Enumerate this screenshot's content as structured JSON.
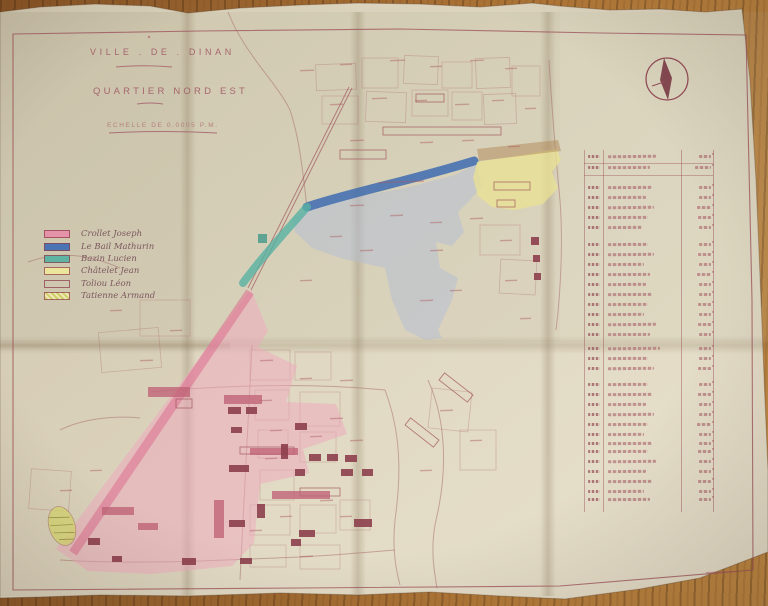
{
  "photo": {
    "subject": "hand-drawn cadastral expropriation plan on folded paper, photographed on a wooden table",
    "wood_color": "#a26b31",
    "paper_color": "#e0d8c2",
    "ink_color": "#9c4f58"
  },
  "title_block": {
    "city": "VILLE . DE . DINAN",
    "district": "QUARTIER NORD EST",
    "scale": "ECHELLE DE 0.0005 P.M."
  },
  "legend": {
    "items": [
      {
        "label": "Crollet Joseph",
        "color": "#e493a9",
        "style": "solid"
      },
      {
        "label": "Le Bail Mathurin",
        "color": "#4a74b4",
        "style": "solid"
      },
      {
        "label": "Bazin Lucien",
        "color": "#5fb3a3",
        "style": "solid"
      },
      {
        "label": "Châtelet Jean",
        "color": "#ece59c",
        "style": "solid"
      },
      {
        "label": "Toliou Léon",
        "color": "none",
        "style": "outline"
      },
      {
        "label": "Tatienne Armand",
        "color": "#d6d66e",
        "style": "hatched"
      }
    ]
  },
  "compass": {
    "icon": "compass-rose",
    "ink": "#7c3a46"
  },
  "register_table": {
    "legible": false,
    "note": "faint handwritten register: parcel number, owner name, surface (m2); text too small to read",
    "rows": [
      {
        "y": 155,
        "nw": 48,
        "vw": 12
      },
      {
        "y": 166,
        "nw": 42,
        "vw": 16
      },
      {
        "y": 186,
        "nw": 44,
        "vw": 12
      },
      {
        "y": 196,
        "nw": 38,
        "vw": 12
      },
      {
        "y": 206,
        "nw": 46,
        "vw": 14
      },
      {
        "y": 216,
        "nw": 40,
        "vw": 13
      },
      {
        "y": 226,
        "nw": 34,
        "vw": 12
      },
      {
        "y": 243,
        "nw": 40,
        "vw": 12
      },
      {
        "y": 253,
        "nw": 46,
        "vw": 13
      },
      {
        "y": 263,
        "nw": 36,
        "vw": 12
      },
      {
        "y": 273,
        "nw": 42,
        "vw": 14
      },
      {
        "y": 283,
        "nw": 38,
        "vw": 12
      },
      {
        "y": 293,
        "nw": 44,
        "vw": 12
      },
      {
        "y": 303,
        "nw": 40,
        "vw": 13
      },
      {
        "y": 313,
        "nw": 36,
        "vw": 12
      },
      {
        "y": 323,
        "nw": 48,
        "vw": 13
      },
      {
        "y": 333,
        "nw": 42,
        "vw": 12
      },
      {
        "y": 347,
        "nw": 52,
        "vw": 12
      },
      {
        "y": 357,
        "nw": 40,
        "vw": 12
      },
      {
        "y": 367,
        "nw": 46,
        "vw": 13
      },
      {
        "y": 383,
        "nw": 40,
        "vw": 12
      },
      {
        "y": 393,
        "nw": 44,
        "vw": 13
      },
      {
        "y": 403,
        "nw": 38,
        "vw": 12
      },
      {
        "y": 413,
        "nw": 46,
        "vw": 12
      },
      {
        "y": 423,
        "nw": 40,
        "vw": 14
      },
      {
        "y": 433,
        "nw": 36,
        "vw": 12
      },
      {
        "y": 442,
        "nw": 44,
        "vw": 12
      },
      {
        "y": 450,
        "nw": 40,
        "vw": 13
      },
      {
        "y": 460,
        "nw": 48,
        "vw": 12
      },
      {
        "y": 470,
        "nw": 38,
        "vw": 12
      },
      {
        "y": 480,
        "nw": 44,
        "vw": 13
      },
      {
        "y": 490,
        "nw": 36,
        "vw": 12
      },
      {
        "y": 498,
        "nw": 42,
        "vw": 12
      }
    ]
  },
  "map": {
    "washes": {
      "pink_zone_owner": "Crollet Joseph",
      "blue_band_owner": "Le Bail Mathurin",
      "teal_band_owner": "Bazin Lucien",
      "yellow_zone_owner": "Châtelet Jean",
      "hatched_blob_owner": "Tatienne Armand"
    },
    "buildings": [
      {
        "x": 383,
        "y": 127,
        "w": 118,
        "h": 8,
        "t": "o"
      },
      {
        "x": 340,
        "y": 150,
        "w": 46,
        "h": 9,
        "t": "o"
      },
      {
        "x": 416,
        "y": 94,
        "w": 28,
        "h": 8,
        "t": "o"
      },
      {
        "x": 494,
        "y": 182,
        "w": 36,
        "h": 8,
        "t": "o"
      },
      {
        "x": 497,
        "y": 200,
        "w": 18,
        "h": 7,
        "t": "o"
      },
      {
        "x": 438,
        "y": 383,
        "w": 36,
        "h": 9,
        "t": "o",
        "r": 38
      },
      {
        "x": 404,
        "y": 428,
        "w": 36,
        "h": 9,
        "t": "o",
        "r": 38
      },
      {
        "x": 300,
        "y": 488,
        "w": 40,
        "h": 8,
        "t": "o"
      },
      {
        "x": 240,
        "y": 447,
        "w": 54,
        "h": 7,
        "t": "o"
      },
      {
        "x": 176,
        "y": 399,
        "w": 16,
        "h": 9,
        "t": "o"
      },
      {
        "x": 148,
        "y": 387,
        "w": 42,
        "h": 10,
        "t": "p"
      },
      {
        "x": 224,
        "y": 395,
        "w": 38,
        "h": 9,
        "t": "p"
      },
      {
        "x": 250,
        "y": 448,
        "w": 48,
        "h": 7,
        "t": "p"
      },
      {
        "x": 272,
        "y": 491,
        "w": 58,
        "h": 8,
        "t": "p"
      },
      {
        "x": 214,
        "y": 500,
        "w": 10,
        "h": 38,
        "t": "p"
      },
      {
        "x": 102,
        "y": 507,
        "w": 32,
        "h": 8,
        "t": "p"
      },
      {
        "x": 138,
        "y": 523,
        "w": 20,
        "h": 7,
        "t": "p"
      },
      {
        "x": 228,
        "y": 407,
        "w": 13,
        "h": 7,
        "t": "s"
      },
      {
        "x": 246,
        "y": 407,
        "w": 11,
        "h": 7,
        "t": "s"
      },
      {
        "x": 231,
        "y": 427,
        "w": 11,
        "h": 6,
        "t": "s"
      },
      {
        "x": 281,
        "y": 444,
        "w": 7,
        "h": 15,
        "t": "s"
      },
      {
        "x": 229,
        "y": 465,
        "w": 20,
        "h": 7,
        "t": "s"
      },
      {
        "x": 295,
        "y": 423,
        "w": 12,
        "h": 7,
        "t": "s"
      },
      {
        "x": 309,
        "y": 454,
        "w": 12,
        "h": 7,
        "t": "s"
      },
      {
        "x": 327,
        "y": 454,
        "w": 11,
        "h": 7,
        "t": "s"
      },
      {
        "x": 345,
        "y": 455,
        "w": 12,
        "h": 7,
        "t": "s"
      },
      {
        "x": 341,
        "y": 469,
        "w": 12,
        "h": 7,
        "t": "s"
      },
      {
        "x": 362,
        "y": 469,
        "w": 11,
        "h": 7,
        "t": "s"
      },
      {
        "x": 295,
        "y": 469,
        "w": 10,
        "h": 7,
        "t": "s"
      },
      {
        "x": 354,
        "y": 519,
        "w": 18,
        "h": 8,
        "t": "s"
      },
      {
        "x": 299,
        "y": 530,
        "w": 16,
        "h": 7,
        "t": "s"
      },
      {
        "x": 229,
        "y": 520,
        "w": 16,
        "h": 7,
        "t": "s"
      },
      {
        "x": 257,
        "y": 504,
        "w": 8,
        "h": 14,
        "t": "s"
      },
      {
        "x": 291,
        "y": 539,
        "w": 10,
        "h": 7,
        "t": "s"
      },
      {
        "x": 182,
        "y": 558,
        "w": 14,
        "h": 7,
        "t": "s"
      },
      {
        "x": 240,
        "y": 558,
        "w": 12,
        "h": 6,
        "t": "s"
      },
      {
        "x": 531,
        "y": 237,
        "w": 8,
        "h": 8,
        "t": "s"
      },
      {
        "x": 533,
        "y": 255,
        "w": 7,
        "h": 7,
        "t": "s"
      },
      {
        "x": 534,
        "y": 273,
        "w": 7,
        "h": 7,
        "t": "s"
      },
      {
        "x": 88,
        "y": 538,
        "w": 12,
        "h": 7,
        "t": "s"
      },
      {
        "x": 112,
        "y": 556,
        "w": 10,
        "h": 6,
        "t": "s"
      },
      {
        "x": 258,
        "y": 234,
        "w": 9,
        "h": 9,
        "t": "tl"
      }
    ],
    "tiny_labels": [
      {
        "x": 300,
        "y": 70,
        "w": 14
      },
      {
        "x": 340,
        "y": 64,
        "w": 12
      },
      {
        "x": 390,
        "y": 60,
        "w": 15
      },
      {
        "x": 430,
        "y": 66,
        "w": 12
      },
      {
        "x": 470,
        "y": 60,
        "w": 14
      },
      {
        "x": 505,
        "y": 68,
        "w": 12
      },
      {
        "x": 330,
        "y": 104,
        "w": 13
      },
      {
        "x": 372,
        "y": 98,
        "w": 15
      },
      {
        "x": 415,
        "y": 100,
        "w": 12
      },
      {
        "x": 455,
        "y": 104,
        "w": 14
      },
      {
        "x": 492,
        "y": 100,
        "w": 12
      },
      {
        "x": 525,
        "y": 108,
        "w": 11
      },
      {
        "x": 350,
        "y": 140,
        "w": 14
      },
      {
        "x": 420,
        "y": 142,
        "w": 13
      },
      {
        "x": 462,
        "y": 140,
        "w": 12
      },
      {
        "x": 508,
        "y": 146,
        "w": 12
      },
      {
        "x": 378,
        "y": 182,
        "w": 46
      },
      {
        "x": 350,
        "y": 205,
        "w": 14
      },
      {
        "x": 390,
        "y": 215,
        "w": 13
      },
      {
        "x": 430,
        "y": 222,
        "w": 12
      },
      {
        "x": 470,
        "y": 218,
        "w": 13
      },
      {
        "x": 330,
        "y": 236,
        "w": 12
      },
      {
        "x": 360,
        "y": 250,
        "w": 13
      },
      {
        "x": 300,
        "y": 280,
        "w": 12
      },
      {
        "x": 430,
        "y": 250,
        "w": 13
      },
      {
        "x": 450,
        "y": 290,
        "w": 12
      },
      {
        "x": 500,
        "y": 240,
        "w": 12
      },
      {
        "x": 505,
        "y": 280,
        "w": 12
      },
      {
        "x": 520,
        "y": 318,
        "w": 11
      },
      {
        "x": 420,
        "y": 300,
        "w": 13
      },
      {
        "x": 260,
        "y": 360,
        "w": 13
      },
      {
        "x": 300,
        "y": 378,
        "w": 12
      },
      {
        "x": 340,
        "y": 380,
        "w": 13
      },
      {
        "x": 260,
        "y": 400,
        "w": 12
      },
      {
        "x": 330,
        "y": 418,
        "w": 13
      },
      {
        "x": 270,
        "y": 430,
        "w": 12
      },
      {
        "x": 310,
        "y": 436,
        "w": 12
      },
      {
        "x": 350,
        "y": 440,
        "w": 13
      },
      {
        "x": 265,
        "y": 458,
        "w": 12
      },
      {
        "x": 320,
        "y": 500,
        "w": 13
      },
      {
        "x": 280,
        "y": 516,
        "w": 12
      },
      {
        "x": 250,
        "y": 530,
        "w": 12
      },
      {
        "x": 340,
        "y": 516,
        "w": 12
      },
      {
        "x": 300,
        "y": 556,
        "w": 13
      },
      {
        "x": 440,
        "y": 410,
        "w": 13
      },
      {
        "x": 470,
        "y": 440,
        "w": 12
      },
      {
        "x": 420,
        "y": 470,
        "w": 12
      },
      {
        "x": 60,
        "y": 490,
        "w": 12
      },
      {
        "x": 90,
        "y": 470,
        "w": 12
      },
      {
        "x": 140,
        "y": 360,
        "w": 13
      },
      {
        "x": 170,
        "y": 330,
        "w": 12
      },
      {
        "x": 110,
        "y": 310,
        "w": 12
      },
      {
        "x": 706,
        "y": 572,
        "w": 28
      }
    ]
  }
}
